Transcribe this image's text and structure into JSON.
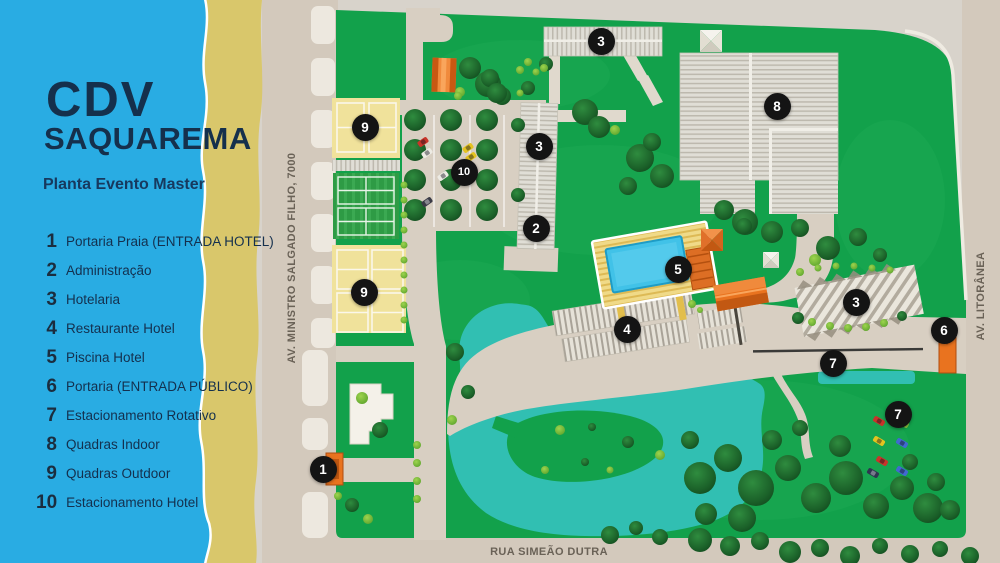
{
  "panel": {
    "title_line1": "CDV",
    "title_line2": "SAQUAREMA",
    "subtitle": "Planta Evento Master",
    "legend": [
      {
        "num": "1",
        "label": "Portaria Praia (ENTRADA HOTEL)"
      },
      {
        "num": "2",
        "label": "Administração"
      },
      {
        "num": "3",
        "label": "Hotelaria"
      },
      {
        "num": "4",
        "label": "Restaurante Hotel"
      },
      {
        "num": "5",
        "label": "Piscina Hotel"
      },
      {
        "num": "6",
        "label": "Portaria (ENTRADA PÚBLICO)"
      },
      {
        "num": "7",
        "label": "Estacionamento Rotativo"
      },
      {
        "num": "8",
        "label": "Quadras Indoor"
      },
      {
        "num": "9",
        "label": "Quadras Outdoor"
      },
      {
        "num": "10",
        "label": "Estacionamento Hotel"
      }
    ]
  },
  "map": {
    "streets": {
      "left": "AV. MINISTRO SALGADO FILHO, 7000",
      "right": "AV. LITORÂNEA",
      "bottom": "RUA SIMEÃO DUTRA"
    },
    "markers": [
      {
        "n": "1",
        "x": 323,
        "y": 469
      },
      {
        "n": "2",
        "x": 536,
        "y": 228
      },
      {
        "n": "3",
        "x": 601,
        "y": 41
      },
      {
        "n": "3",
        "x": 539,
        "y": 146
      },
      {
        "n": "3",
        "x": 856,
        "y": 302
      },
      {
        "n": "4",
        "x": 627,
        "y": 329
      },
      {
        "n": "5",
        "x": 678,
        "y": 269
      },
      {
        "n": "6",
        "x": 944,
        "y": 330
      },
      {
        "n": "7",
        "x": 833,
        "y": 363
      },
      {
        "n": "7",
        "x": 898,
        "y": 414
      },
      {
        "n": "8",
        "x": 777,
        "y": 106
      },
      {
        "n": "9",
        "x": 365,
        "y": 127
      },
      {
        "n": "9",
        "x": 364,
        "y": 292
      },
      {
        "n": "10",
        "x": 464,
        "y": 172
      }
    ],
    "colors": {
      "panel_blue": "#29ACE3",
      "sand": "#D9C76B",
      "navy": "#15304C",
      "site_green": "#12A14B",
      "lake_teal": "#31BFB2",
      "road_tan": "#D6CCBF",
      "marker_bg": "#141414",
      "orange": "#E9731F"
    }
  }
}
